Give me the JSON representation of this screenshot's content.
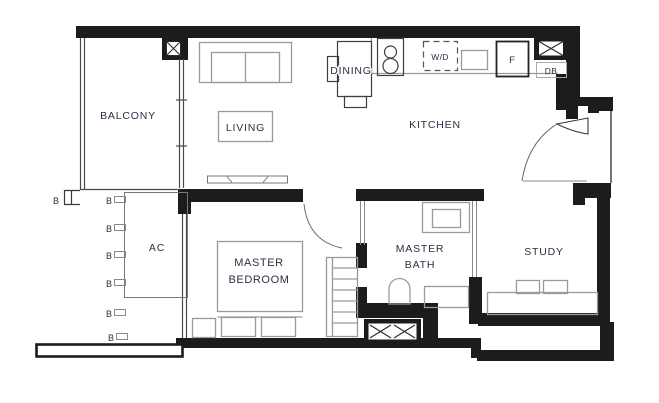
{
  "colors": {
    "wall": "#1c1c1c",
    "furniture": "#9a9a9a",
    "dark_outline": "#3f3f3f",
    "text": "#2a3042",
    "background": "#ffffff"
  },
  "rooms": {
    "balcony": {
      "label": "BALCONY"
    },
    "living": {
      "label": "LIVING"
    },
    "dining": {
      "label": "DINING"
    },
    "kitchen": {
      "label": "KITCHEN"
    },
    "master_bedroom": {
      "line1": "MASTER",
      "line2": "BEDROOM"
    },
    "master_bath": {
      "line1": "MASTER",
      "line2": "BATH"
    },
    "study": {
      "label": "STUDY"
    },
    "ac_ledge": {
      "label": "AC"
    }
  },
  "fixtures": {
    "washer_dryer": {
      "label": "W/D"
    },
    "fridge": {
      "label": "F"
    },
    "db": {
      "label": "DB"
    }
  },
  "markers": {
    "balustrade": "B"
  }
}
